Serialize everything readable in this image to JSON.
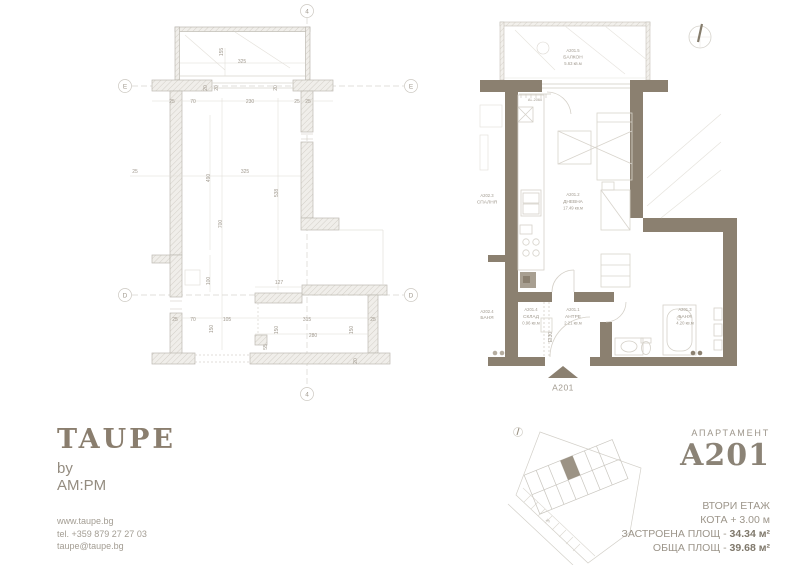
{
  "branding": {
    "logo_title": "TAUPE",
    "logo_by": "by",
    "logo_brand": "AM:PM",
    "website": "www.taupe.bg",
    "phone": "tel. +359 879 27 27 03",
    "email": "taupe@taupe.bg"
  },
  "apartment": {
    "label": "АПАРТАМЕНТ",
    "number": "A201",
    "floor": "ВТОРИ ЕТАЖ",
    "elevation": "КОТА + 3.00 м",
    "built_label": "ЗАСТРОЕНА ПЛОЩ - ",
    "built_value": "34.34 м²",
    "total_label": "ОБЩА ПЛОЩ - ",
    "total_value": "39.68 м²"
  },
  "construction_plan": {
    "axis_vertical": "4",
    "axis_e": "E",
    "axis_d": "D",
    "dims": [
      "325",
      "155",
      "25",
      "70",
      "230",
      "25",
      "25",
      "20",
      "20",
      "20",
      "25",
      "490",
      "325",
      "538",
      "700",
      "100",
      "127",
      "25",
      "70",
      "105",
      "315",
      "25",
      "150",
      "150",
      "280",
      "150",
      "55",
      "20"
    ]
  },
  "furnished_plan": {
    "window_label": "AL.2060",
    "fire_door_label": "EI30",
    "entrance_label": "A201",
    "rooms": {
      "balcony": {
        "id": "A201.5",
        "name": "БАЛКОН",
        "area": "5.63 кв.м"
      },
      "living": {
        "id": "A201.2",
        "name": "ДНЕВНА",
        "area": "17.49 кв.м"
      },
      "storage": {
        "id": "A201.4",
        "name": "СКЛАД",
        "area": "0.96 кв.м"
      },
      "hall": {
        "id": "A201.1",
        "name": "АНТРЕ",
        "area": "2.21 кв.м"
      },
      "bath": {
        "id": "A201.3",
        "name": "БАНЯ",
        "area": "4.20 кв.м"
      },
      "neighbor_bedroom": {
        "id": "A202.3",
        "name": "СПАЛНЯ"
      },
      "neighbor_bath": {
        "id": "A202.4",
        "name": "БАНЯ"
      }
    }
  },
  "site_plan": {
    "street_label": "ул."
  },
  "colors": {
    "taupe": "#8b8070",
    "logo": "#8a7e6e",
    "label_text": "#a19a8f",
    "dim_text": "#b0aba3",
    "light_line": "#d5d1c9"
  }
}
